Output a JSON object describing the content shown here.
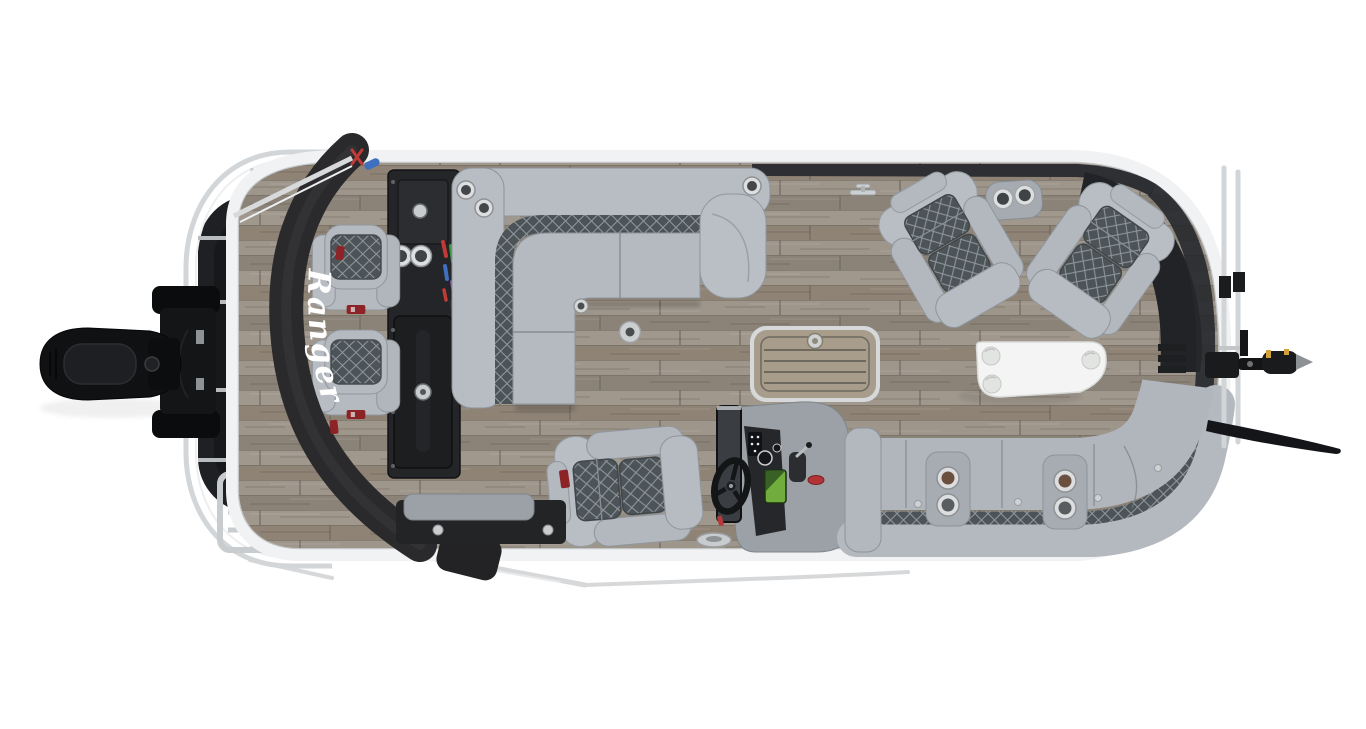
{
  "scene": {
    "type": "overhead product photo",
    "subject": "pontoon fishing boat interior layout, top-down view, bow right and outboard motor left",
    "brand_label": "Ranger",
    "background_color": "#ffffff"
  },
  "colors": {
    "upholstery_gray": "#b4bac0",
    "quilt_dark": "#4d5458",
    "deck_wood": "#958d83",
    "bumper_black": "#2a2a2c",
    "gear_console_black": "#232528",
    "helm_console_gray": "#9ba1a7",
    "table_white": "#f3f4f3",
    "hatch_mat_tan": "#a89c8a",
    "rail_silver": "#d3d6d8",
    "accent_red": "#b23436",
    "fishfinder_green": "#70ad3c",
    "motor_black": "#101113"
  }
}
